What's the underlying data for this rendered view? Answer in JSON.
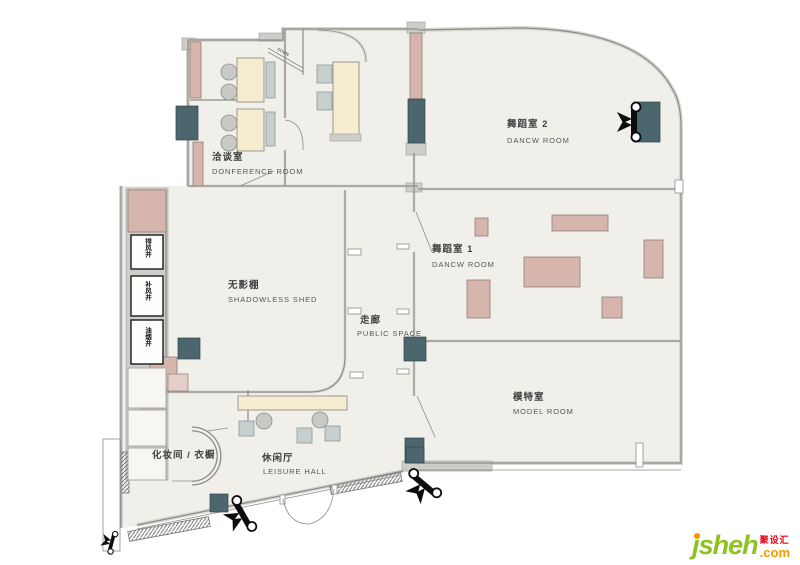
{
  "rooms": {
    "conference": {
      "zh": "洽谈室",
      "en": "DONFERENCE ROOM"
    },
    "dance2": {
      "zh": "舞蹈室 2",
      "en": "DANCW  ROOM"
    },
    "dance1": {
      "zh": "舞蹈室 1",
      "en": "DANCW  ROOM"
    },
    "shadowless": {
      "zh": "无影棚",
      "en": "SHADOWLESS SHED"
    },
    "corridor": {
      "zh": "走廊",
      "en": "PUBLIC  SPACE"
    },
    "model": {
      "zh": "模特室",
      "en": "MODEL  ROOM"
    },
    "leisure": {
      "zh": "休闲厅",
      "en": "LEISURE  HALL"
    },
    "makeup": {
      "zh": "化妆间 / 衣橱"
    }
  },
  "shafts": [
    {
      "label": "排风井"
    },
    {
      "label": "补风井"
    },
    {
      "label": "油烟井"
    }
  ],
  "stair": {
    "down_label": "DOWN"
  },
  "logo": {
    "brand": "jsheh",
    "tld": ".com",
    "zh": "聚设汇"
  },
  "colors": {
    "floor": "#f0efea",
    "wall": "#8b8b89",
    "furniture_pink": "#d6b5ad",
    "furniture_cream": "#f6ecd0",
    "equipment_teal": "#4c666d",
    "logo_green": "#8dc21f",
    "logo_orange": "#f39800",
    "logo_red": "#e60012"
  }
}
